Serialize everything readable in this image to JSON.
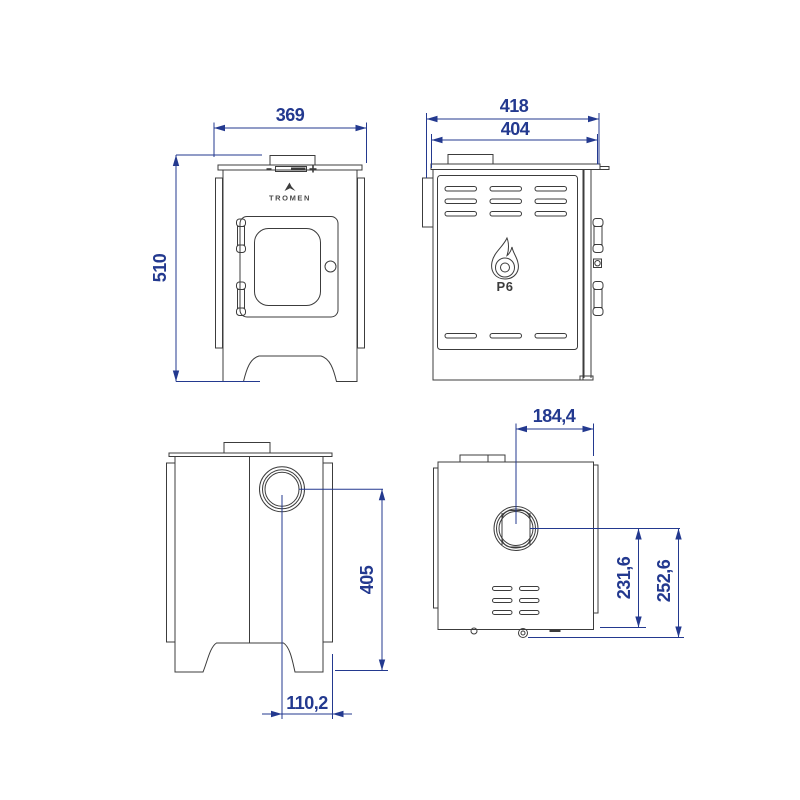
{
  "colors": {
    "dimension": "#23398f",
    "line": "#3c3c3c",
    "background": "#ffffff"
  },
  "views": {
    "front": {
      "brand_logo": "TROMEN",
      "dims": {
        "width": "369",
        "height": "510"
      }
    },
    "side": {
      "model_logo": "P6",
      "dims": {
        "depth_total": "418",
        "depth_body": "404"
      }
    },
    "back": {
      "dims": {
        "flue_height": "405",
        "flue_offset": "110,2"
      }
    },
    "top": {
      "dims": {
        "flue_center_offset": "184,4",
        "flue_to_base": "231,6",
        "flue_to_floor": "252,6"
      }
    }
  }
}
